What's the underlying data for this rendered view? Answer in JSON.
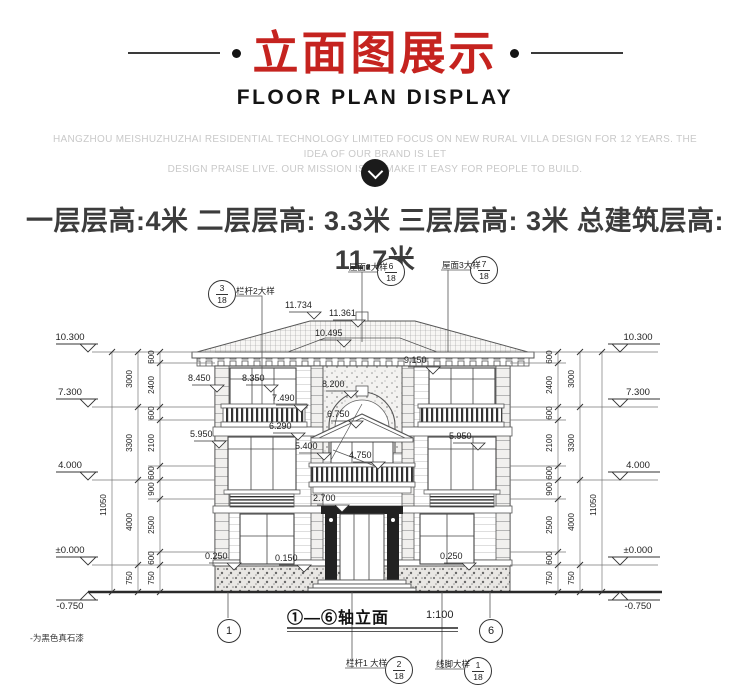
{
  "header": {
    "title": "立面图展示",
    "subtitle": "FLOOR PLAN DISPLAY",
    "description_line1": "HANGZHOU MEISHUZHUZHAI RESIDENTIAL TECHNOLOGY LIMITED  FOCUS ON NEW RURAL VILLA DESIGN FOR 12 YEARS. THE IDEA OF OUR BRAND IS LET",
    "description_line2": "DESIGN PRAISE LIVE.  OUR MISSION IS TO MAKE IT EASY FOR PEOPLE TO BUILD."
  },
  "floor_info": "一层层高:4米  二层层高: 3.3米 三层层高: 3米 总建筑层高: 11.7米",
  "colors": {
    "accent_red": "#c5231f",
    "subtitle_black": "#141414",
    "desc_gray": "#c9c9c9",
    "drawing_line": "#555555"
  },
  "drawing": {
    "markers": {
      "railing2": {
        "label": "栏杆2大样",
        "num": "3",
        "den": "18"
      },
      "roof2": {
        "label": "屋面2大样",
        "num": "6",
        "den": "18"
      },
      "roof3": {
        "label": "屋面3大样",
        "num": "7",
        "den": "18"
      },
      "railing1": {
        "label": "栏杆1 大样",
        "num": "2",
        "den": "18"
      },
      "molding": {
        "label": "线脚大样",
        "num": "1",
        "den": "18"
      },
      "axis_left": "1",
      "axis_right": "6"
    },
    "roof_dims": {
      "peak": "11.734",
      "ridge": "11.361",
      "lower": "10.495"
    },
    "levels_left": {
      "l1": "10.300",
      "l2": "7.300",
      "l3": "4.000",
      "l4": "±0.000",
      "l5": "-0.750"
    },
    "levels_right": {
      "l1": "10.300",
      "l2": "7.300",
      "l3": "4.000",
      "l4": "±0.000",
      "l5": "-0.750"
    },
    "dims_outer": {
      "left": "11050",
      "right": "11050"
    },
    "dims_mid_left": [
      "3000",
      "3300",
      "4000",
      "750"
    ],
    "dims_mid_right": [
      "3000",
      "3300",
      "4000",
      "750"
    ],
    "dims_inner_left": [
      "600",
      "2400",
      "600",
      "2100",
      "600",
      "900",
      "2500",
      "600",
      "750"
    ],
    "dims_inner_right": [
      "600",
      "2400",
      "600",
      "2100",
      "600",
      "900",
      "2500",
      "600",
      "750"
    ],
    "facade_levels": {
      "v9150": "9.150",
      "v8450": "8.450",
      "v8350": "8.350",
      "v8200": "8.200",
      "v7490": "7.490",
      "v6750": "6.750",
      "v6290": "6.290",
      "v5950_left": "5.950",
      "v5950_right": "5.950",
      "v5400": "5.400",
      "v4750": "4.750",
      "v2700": "2.700",
      "v0250_left": "0.250",
      "v0150": "0.150",
      "v0250_right": "0.250"
    },
    "caption": {
      "title": "①—⑥轴立面",
      "scale": "1:100"
    },
    "note": "-为黑色真石漆"
  }
}
